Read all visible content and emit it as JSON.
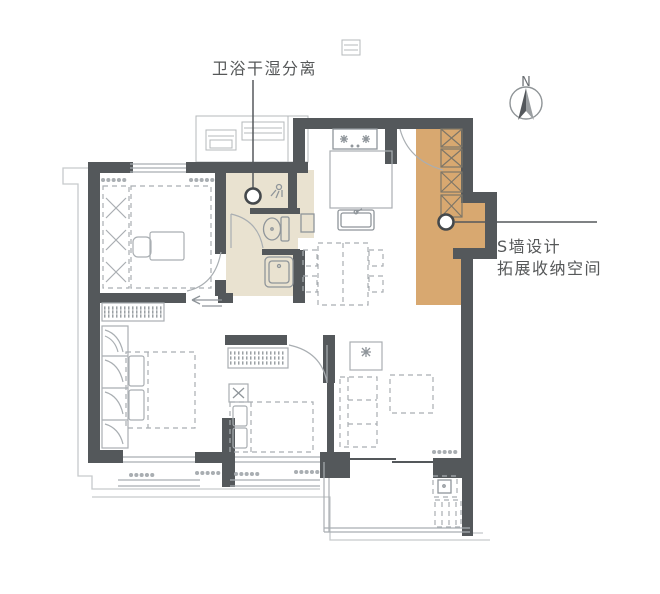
{
  "annotations": {
    "bathroom": {
      "label": "卫浴干湿分离"
    },
    "swall": {
      "line1": "S墙设计",
      "line2": "拓展收纳空间"
    }
  },
  "compass": {
    "label": "N"
  },
  "colors": {
    "wall": "#54585B",
    "bathroom_fill": "#E9E2D0",
    "storage_fill": "#D8A870",
    "furniture_line": "#A9AEB2",
    "fixture_line": "#8F959A",
    "annotation_text": "#565859",
    "leader_line": "#55595C",
    "boundary_line": "#C7CACC",
    "background": "#FFFFFF"
  }
}
